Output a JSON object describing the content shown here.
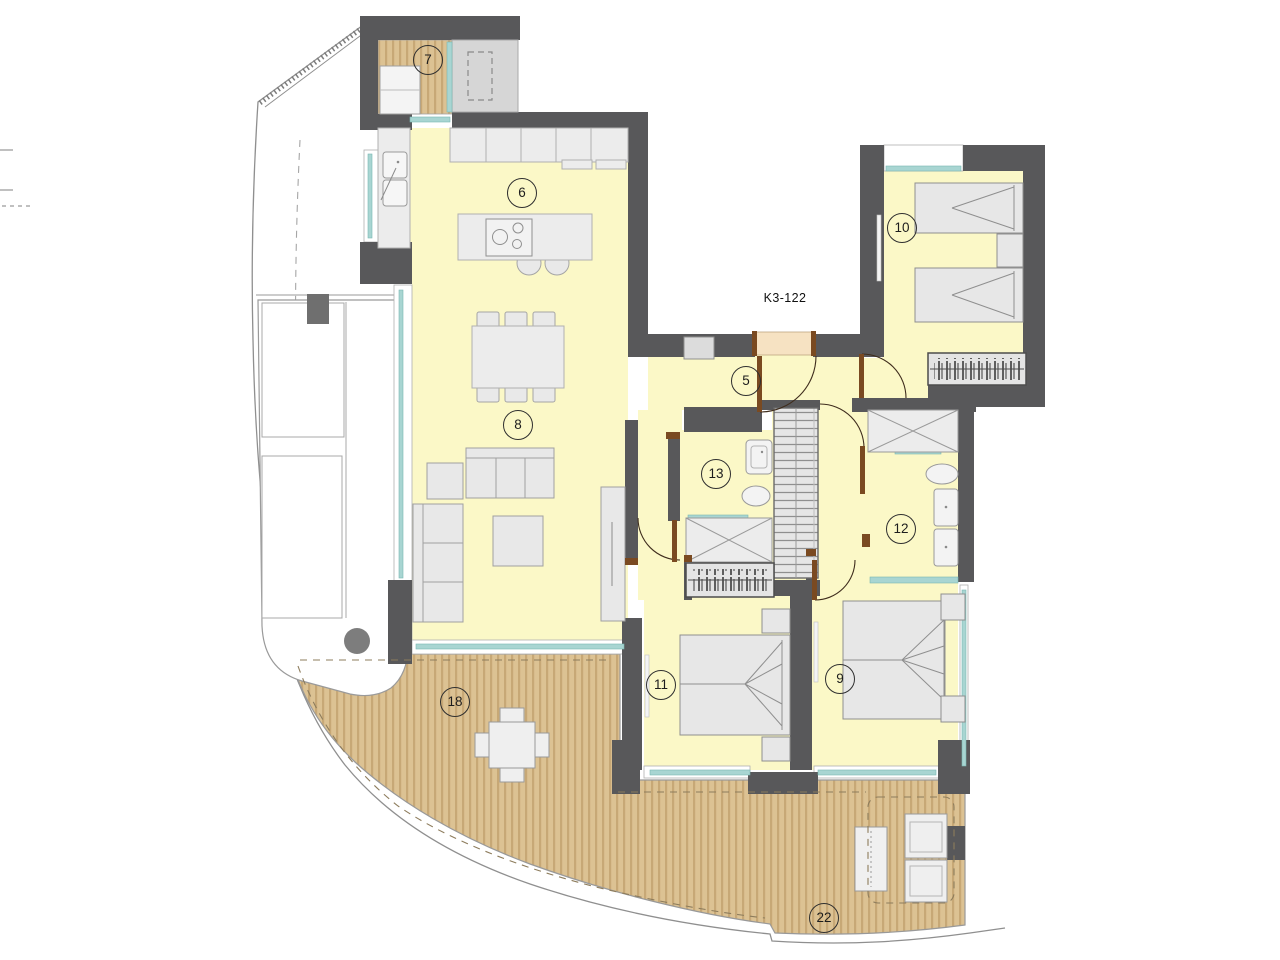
{
  "floor_plan": {
    "unit_label": "K3-122",
    "labels": [
      {
        "id": "balcony-7",
        "text": "7"
      },
      {
        "id": "kitchen-6",
        "text": "6"
      },
      {
        "id": "hall-5",
        "text": "5"
      },
      {
        "id": "living-8",
        "text": "8"
      },
      {
        "id": "bedroom-10",
        "text": "10"
      },
      {
        "id": "bath-13",
        "text": "13"
      },
      {
        "id": "bath-12",
        "text": "12"
      },
      {
        "id": "bedroom-11",
        "text": "11"
      },
      {
        "id": "bedroom-9",
        "text": "9"
      },
      {
        "id": "terrace-18",
        "text": "18"
      },
      {
        "id": "terrace-22",
        "text": "22"
      }
    ],
    "colors": {
      "wall": "#58585a",
      "interior_floor": "#fbf8c7",
      "deck_base": "#dcc293",
      "deck_stripe": "#c7a876",
      "glass": "#a8d5d2",
      "furniture_fill": "#eaeaea",
      "furniture_stroke": "#a0a0a0",
      "entry_door_fill": "#f6e2c2",
      "door_frame": "#7a4a21",
      "shaft_fill": "#d6d6d6",
      "label_text": "#1d1d1d"
    }
  }
}
